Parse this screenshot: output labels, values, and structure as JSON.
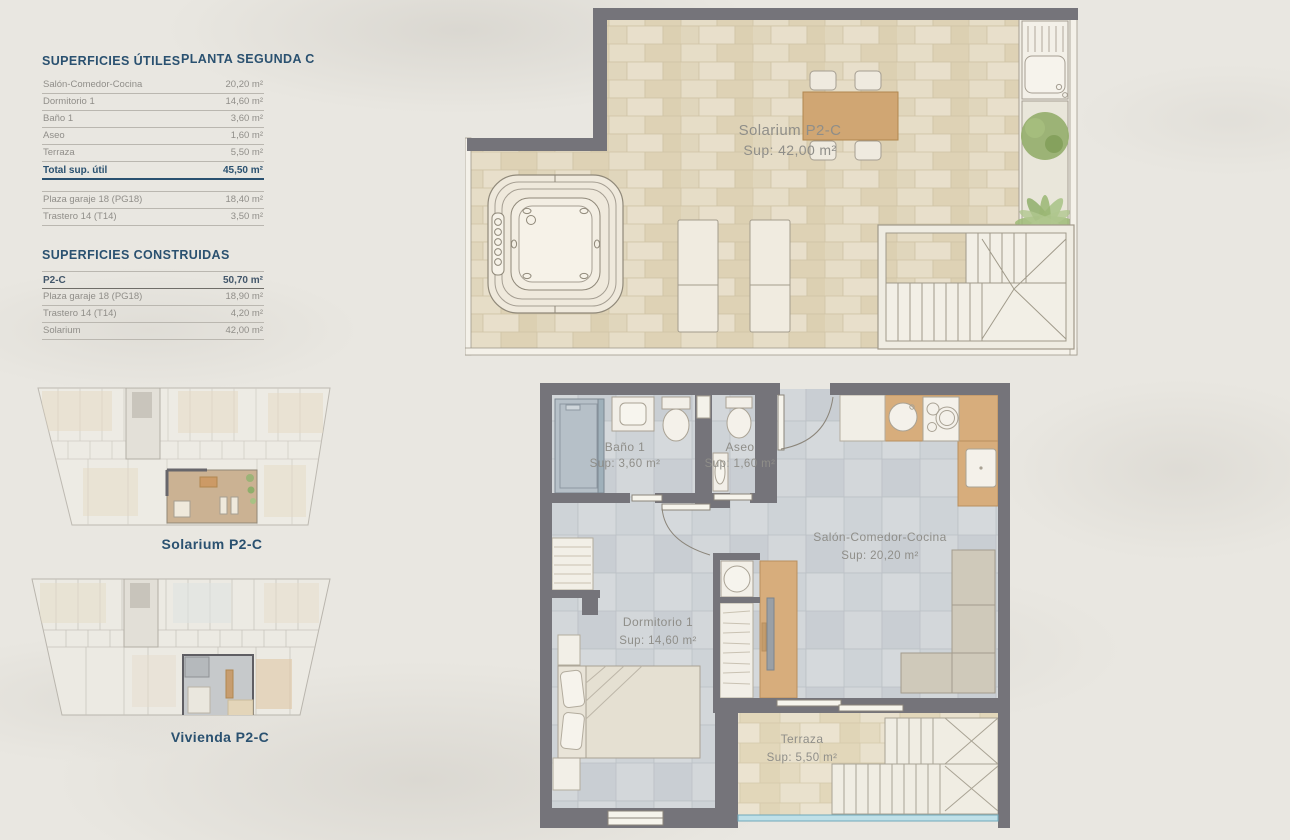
{
  "page": {
    "background": "#e9e7e1",
    "accent_blue": "#2a5170",
    "text_gray": "#908e89",
    "wall_gray": "#75747a",
    "wood": "#d7ad7c",
    "glass_blue": "#bfe0e8"
  },
  "superficies_utiles": {
    "title": "SUPERFICIES ÚTILES",
    "planta": "PLANTA SEGUNDA C",
    "rows": [
      {
        "label": "Salón-Comedor-Cocina",
        "value": "20,20 m²"
      },
      {
        "label": "Dormitorio 1",
        "value": "14,60 m²"
      },
      {
        "label": "Baño 1",
        "value": "3,60 m²"
      },
      {
        "label": "Aseo",
        "value": "1,60 m²"
      },
      {
        "label": "Terraza",
        "value": "5,50 m²"
      }
    ],
    "total": {
      "label": "Total sup. útil",
      "value": "45,50 m²"
    },
    "anexos": [
      {
        "label": "Plaza garaje 18 (PG18)",
        "value": "18,40 m²"
      },
      {
        "label": "Trastero 14 (T14)",
        "value": "3,50 m²"
      }
    ]
  },
  "superficies_construidas": {
    "title": "SUPERFICIES CONSTRUIDAS",
    "rows": [
      {
        "label": "P2-C",
        "value": "50,70 m²"
      },
      {
        "label": "Plaza garaje 18 (PG18)",
        "value": "18,90 m²"
      },
      {
        "label": "Trastero 14 (T14)",
        "value": "4,20 m²"
      },
      {
        "label": "Solarium",
        "value": "42,00 m²"
      }
    ]
  },
  "solarium_plan": {
    "room_name": "Solarium P2-C",
    "room_sup": "Sup: 42,00 m²"
  },
  "vivienda_plan": {
    "bano": {
      "name": "Baño 1",
      "sup": "Sup: 3,60 m²"
    },
    "aseo": {
      "name": "Aseo",
      "sup": "Sup: 1,60 m²"
    },
    "salon": {
      "name": "Salón-Comedor-Cocina",
      "sup": "Sup: 20,20 m²"
    },
    "dormitorio": {
      "name": "Dormitorio 1",
      "sup": "Sup: 14,60 m²"
    },
    "terraza": {
      "name": "Terraza",
      "sup": "Sup: 5,50 m²"
    }
  },
  "mini_plans": {
    "solarium_caption": "Solarium P2-C",
    "vivienda_caption": "Vivienda P2-C"
  }
}
